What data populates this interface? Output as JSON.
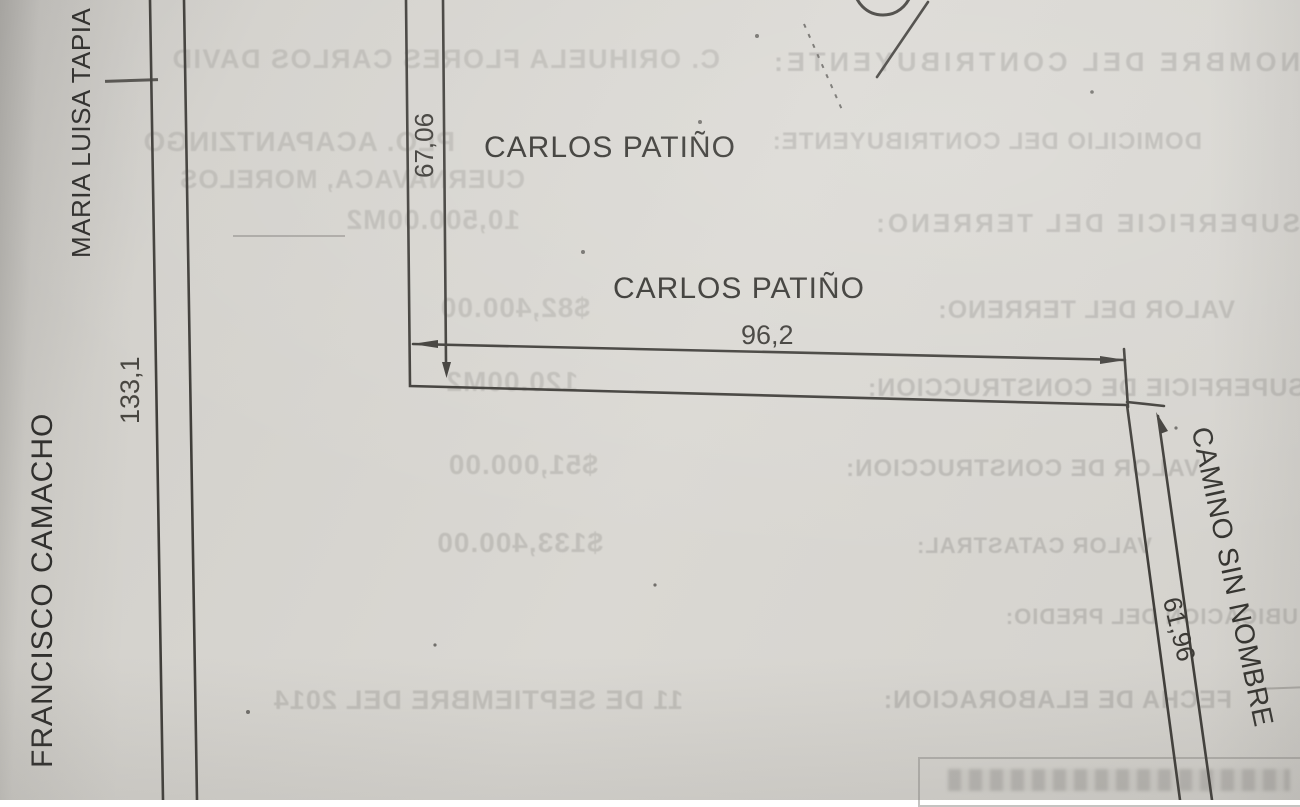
{
  "document": {
    "kind": "scanned cadastral plot sketch (croquis)"
  },
  "plot_labels": {
    "west_outer_neighbor": "MARIA LUISA TAPIA",
    "west_lower_neighbor": "FRANCISCO CAMACHO",
    "north_neighbor_top": "CARLOS PATIÑO",
    "north_neighbor_inner": "CARLOS PATIÑO",
    "east_road": "CAMINO SIN NOMBRE"
  },
  "dimensions": {
    "west_length": "133,1",
    "north_west_length": "67,06",
    "north_length": "96,2",
    "east_length": "61,96"
  },
  "bleedthrough": {
    "note": "mirrored show-through text from reverse side of page",
    "rows": [
      {
        "label": "NOMBRE DEL CONTRIBUYENTE:",
        "value": "C. ORIHUELA FLORES CARLOS DAVID"
      },
      {
        "label": "DOMICILIO DEL CONTRIBUYENTE:",
        "value": "PLO. ACAPANTZINGO"
      },
      {
        "label": "",
        "value": "CUERNAVACA, MORELOS"
      },
      {
        "label": "SUPERFICIE DEL TERRENO:",
        "value": "10,500.00M2"
      },
      {
        "label": "VALOR DEL TERRENO:",
        "value": "$82,400.00"
      },
      {
        "label": "SUPERFICIE DE CONSTRUCCION:",
        "value": "120.00M2"
      },
      {
        "label": "VALOR DE CONSTRUCCION:",
        "value": "$51,000.00"
      },
      {
        "label": "VALOR CATASTRAL:",
        "value": "$133,400.00"
      },
      {
        "label": "UBICACION DEL PREDIO:",
        "value": ""
      },
      {
        "label": "FECHA DE ELABORACION:",
        "value": "11 DE SEPTIEMBRE DEL 2014"
      }
    ]
  }
}
